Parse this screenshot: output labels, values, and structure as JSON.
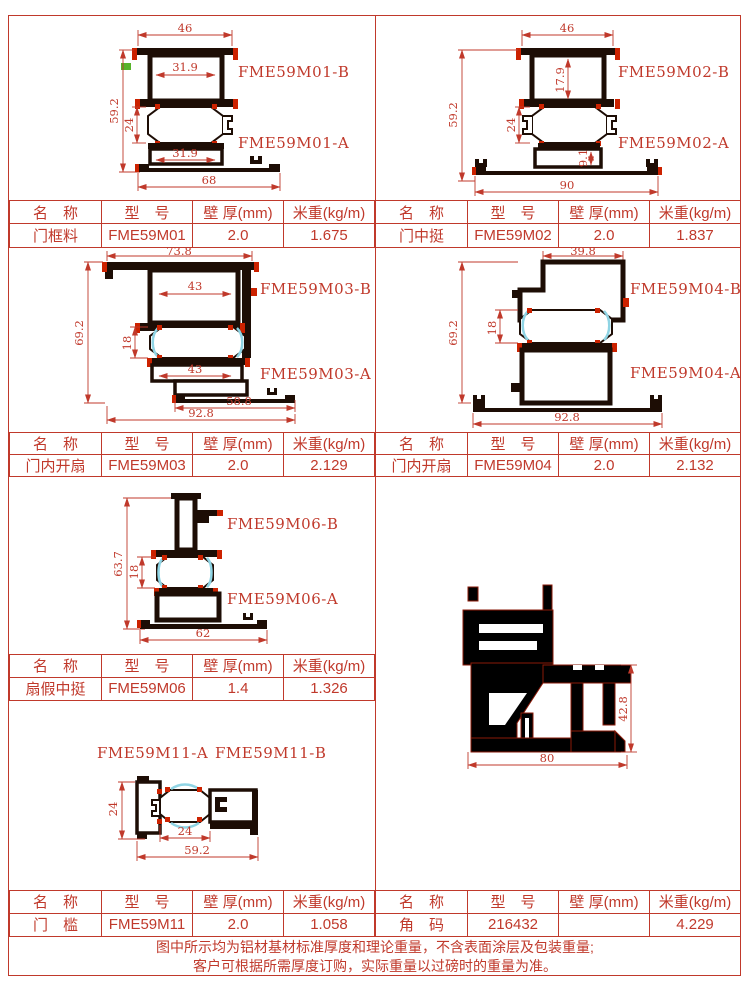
{
  "colors": {
    "line_red": "#c0392b",
    "profile_dark": "#1d0d05",
    "accent_red": "#cc2200",
    "thermal_break_cyan": "#8fd4e4",
    "swatch_green": "#58b32a",
    "corner_black": "#000000"
  },
  "tables": {
    "headers": [
      "名　称",
      "型　号",
      "壁 厚(mm)",
      "米重(kg/m)"
    ],
    "rows": {
      "t1l": {
        "name": "门框料",
        "model": "FME59M01",
        "thickness": "2.0",
        "weight": "1.675"
      },
      "t1r": {
        "name": "门中挺",
        "model": "FME59M02",
        "thickness": "2.0",
        "weight": "1.837"
      },
      "t2l": {
        "name": "门内开扇",
        "model": "FME59M03",
        "thickness": "2.0",
        "weight": "2.129"
      },
      "t2r": {
        "name": "门内开扇",
        "model": "FME59M04",
        "thickness": "2.0",
        "weight": "2.132"
      },
      "t3l": {
        "name": "扇假中挺",
        "model": "FME59M06",
        "thickness": "1.4",
        "weight": "1.326"
      },
      "t4l": {
        "name": "门　槛",
        "model": "FME59M11",
        "thickness": "2.0",
        "weight": "1.058"
      },
      "t4r": {
        "name": "角　码",
        "model": "216432",
        "thickness": "",
        "weight": "4.229"
      }
    }
  },
  "drawings": {
    "m01": {
      "label_b": "FME59M01-B",
      "label_a": "FME59M01-A",
      "dim_top": "46",
      "dim_upper_inner": "31.9",
      "dim_height": "59.2",
      "dim_chamber": "24",
      "dim_lower_inner": "31.9",
      "dim_bottom": "68"
    },
    "m02": {
      "label_b": "FME59M02-B",
      "label_a": "FME59M02-A",
      "dim_top": "46",
      "dim_upper_inner": "17.9",
      "dim_height": "59.2",
      "dim_chamber": "24",
      "dim_lower_inner": "9.1",
      "dim_bottom": "90"
    },
    "m03": {
      "label_b": "FME59M03-B",
      "label_a": "FME59M03-A",
      "dim_top": "73.8",
      "dim_upper_inner": "43",
      "dim_height": "69.2",
      "dim_chamber": "18",
      "dim_lower_inner": "43",
      "dim_bottom_inner": "58.8",
      "dim_bottom": "92.8"
    },
    "m04": {
      "label_b": "FME59M04-B",
      "label_a": "FME59M04-A",
      "dim_top": "39.8",
      "dim_height": "69.2",
      "dim_chamber": "18",
      "dim_bottom": "92.8"
    },
    "m06": {
      "label_b": "FME59M06-B",
      "label_a": "FME59M06-A",
      "dim_height": "63.7",
      "dim_chamber": "18",
      "dim_bottom": "62"
    },
    "m11": {
      "label_a": "FME59M11-A",
      "label_b": "FME59M11-B",
      "dim_left": "24",
      "dim_chamber": "24",
      "dim_bottom": "59.2"
    },
    "corner": {
      "dim_height": "42.8",
      "dim_bottom": "80"
    }
  },
  "notes": {
    "line1": "图中所示均为铝材基材标准厚度和理论重量，不含表面涂层及包装重量;",
    "line2": "客户可根据所需厚度订购，实际重量以过磅时的重量为准。"
  }
}
